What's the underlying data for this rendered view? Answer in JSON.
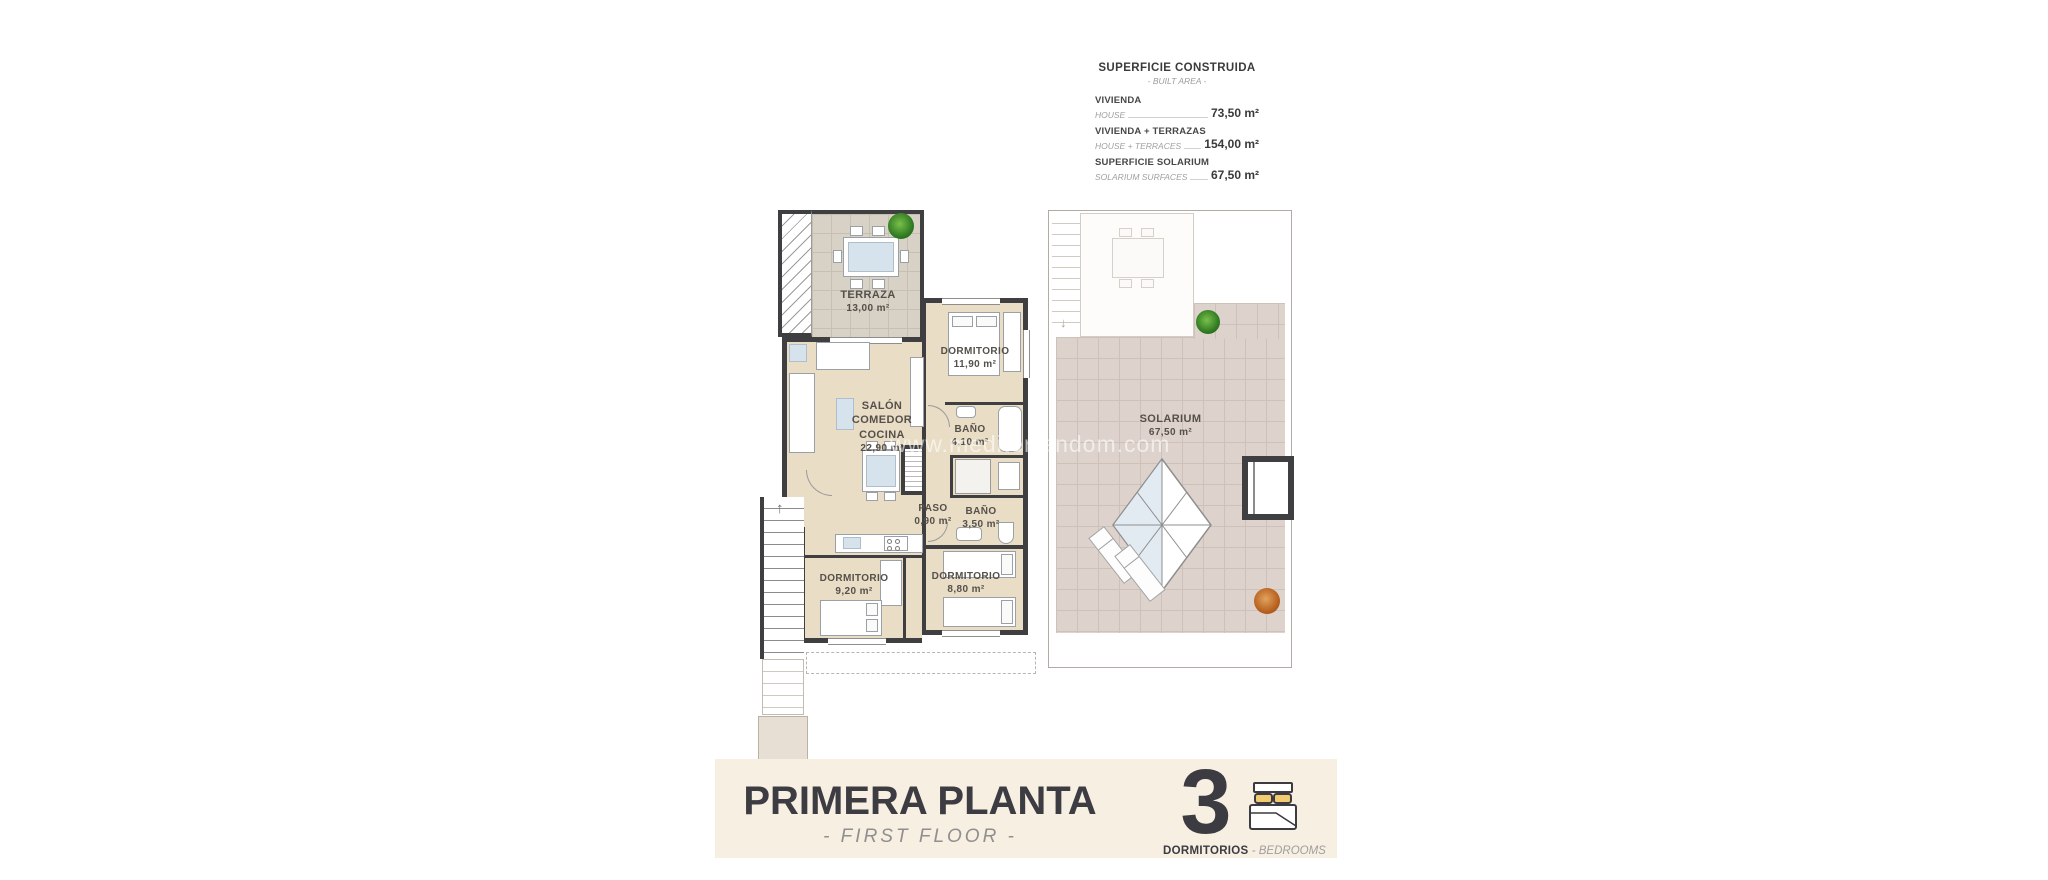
{
  "watermark": "www.mediterrandom.com",
  "area_table": {
    "title": "SUPERFICIE CONSTRUIDA",
    "subtitle": "- BUILT AREA -",
    "rows": [
      {
        "label_es": "VIVIENDA",
        "label_en": "HOUSE",
        "value": "73,50 m²"
      },
      {
        "label_es": "VIVIENDA + TERRAZAS",
        "label_en": "HOUSE + TERRACES",
        "value": "154,00 m²"
      },
      {
        "label_es": "SUPERFICIE SOLARIUM",
        "label_en": "SOLARIUM SURFACES",
        "value": "67,50 m²"
      }
    ]
  },
  "plan": {
    "rooms": {
      "terraza": {
        "name": "TERRAZA",
        "area": "13,00 m²"
      },
      "salon": {
        "line1": "SALÓN",
        "line2": "COMEDOR",
        "line3": "COCINA",
        "area": "22,90 m²"
      },
      "dormitorio_principal": {
        "name": "DORMITORIO",
        "area": "11,90 m²"
      },
      "bano_1": {
        "name": "BAÑO",
        "area": "4,10 m²"
      },
      "paso": {
        "name": "PASO",
        "area": "0,90 m²"
      },
      "bano_2": {
        "name": "BAÑO",
        "area": "3,50 m²"
      },
      "dormitorio_2": {
        "name": "DORMITORIO",
        "area": "9,20 m²"
      },
      "dormitorio_3": {
        "name": "DORMITORIO",
        "area": "8,80 m²"
      },
      "solarium": {
        "name": "SOLARIUM",
        "area": "67,50 m²"
      }
    },
    "icons": {
      "stairs_up_arrow": "↑",
      "stairs_down_arrow": "↓"
    }
  },
  "banner": {
    "title": "PRIMERA PLANTA",
    "subtitle": "- FIRST FLOOR -",
    "bedrooms_count": "3",
    "bedrooms_label_es": "DORMITORIOS",
    "bedrooms_label_en": "- BEDROOMS"
  },
  "colors": {
    "wall": "#3f3e41",
    "floor_interior": "#eaddc6",
    "floor_terrace": "#d8d1c6",
    "floor_solarium": "#ded3cc",
    "banner_background": "#f7efe2",
    "accent_pillow_yellow": "#f2cb70",
    "text_dark": "#3b3b3b",
    "text_gray_italic": "#9b9b9b"
  }
}
